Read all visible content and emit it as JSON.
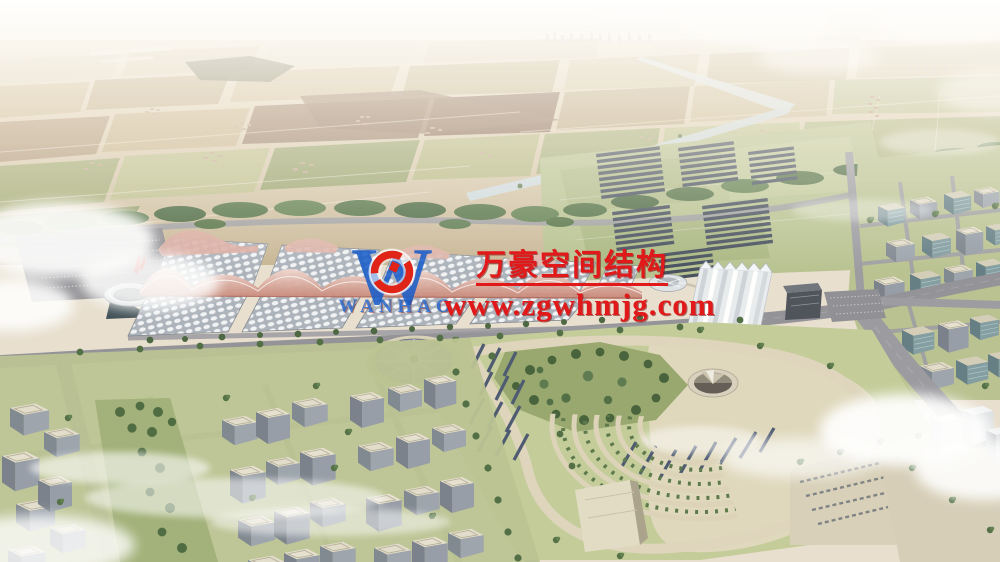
{
  "watermark": {
    "company_name": "万豪空间结构",
    "website": "www.zgwhmjg.com",
    "logo_letter": "W",
    "logo_text": "WANHAO",
    "text_color": "#e1191a",
    "logo_blue": "#1a5dc8",
    "logo_red": "#e02418"
  },
  "palette": {
    "sky_haze": "#f4ede2",
    "farmland_tan": "#c9b994",
    "farmland_brown": "#8a6b52",
    "field_green": "#a9b37f",
    "tree_green": "#4e6d3f",
    "road_grey": "#8e8e94",
    "hall_roof_white": "#e7eaee",
    "wave_roof_pink": "#d79a8c",
    "solar_panel_dark": "#3e4857",
    "lawn_green": "#b8c18e",
    "path_beige": "#ddd4ba",
    "canal_blue": "#d2dfe4",
    "cloud_white": "#ffffff"
  }
}
